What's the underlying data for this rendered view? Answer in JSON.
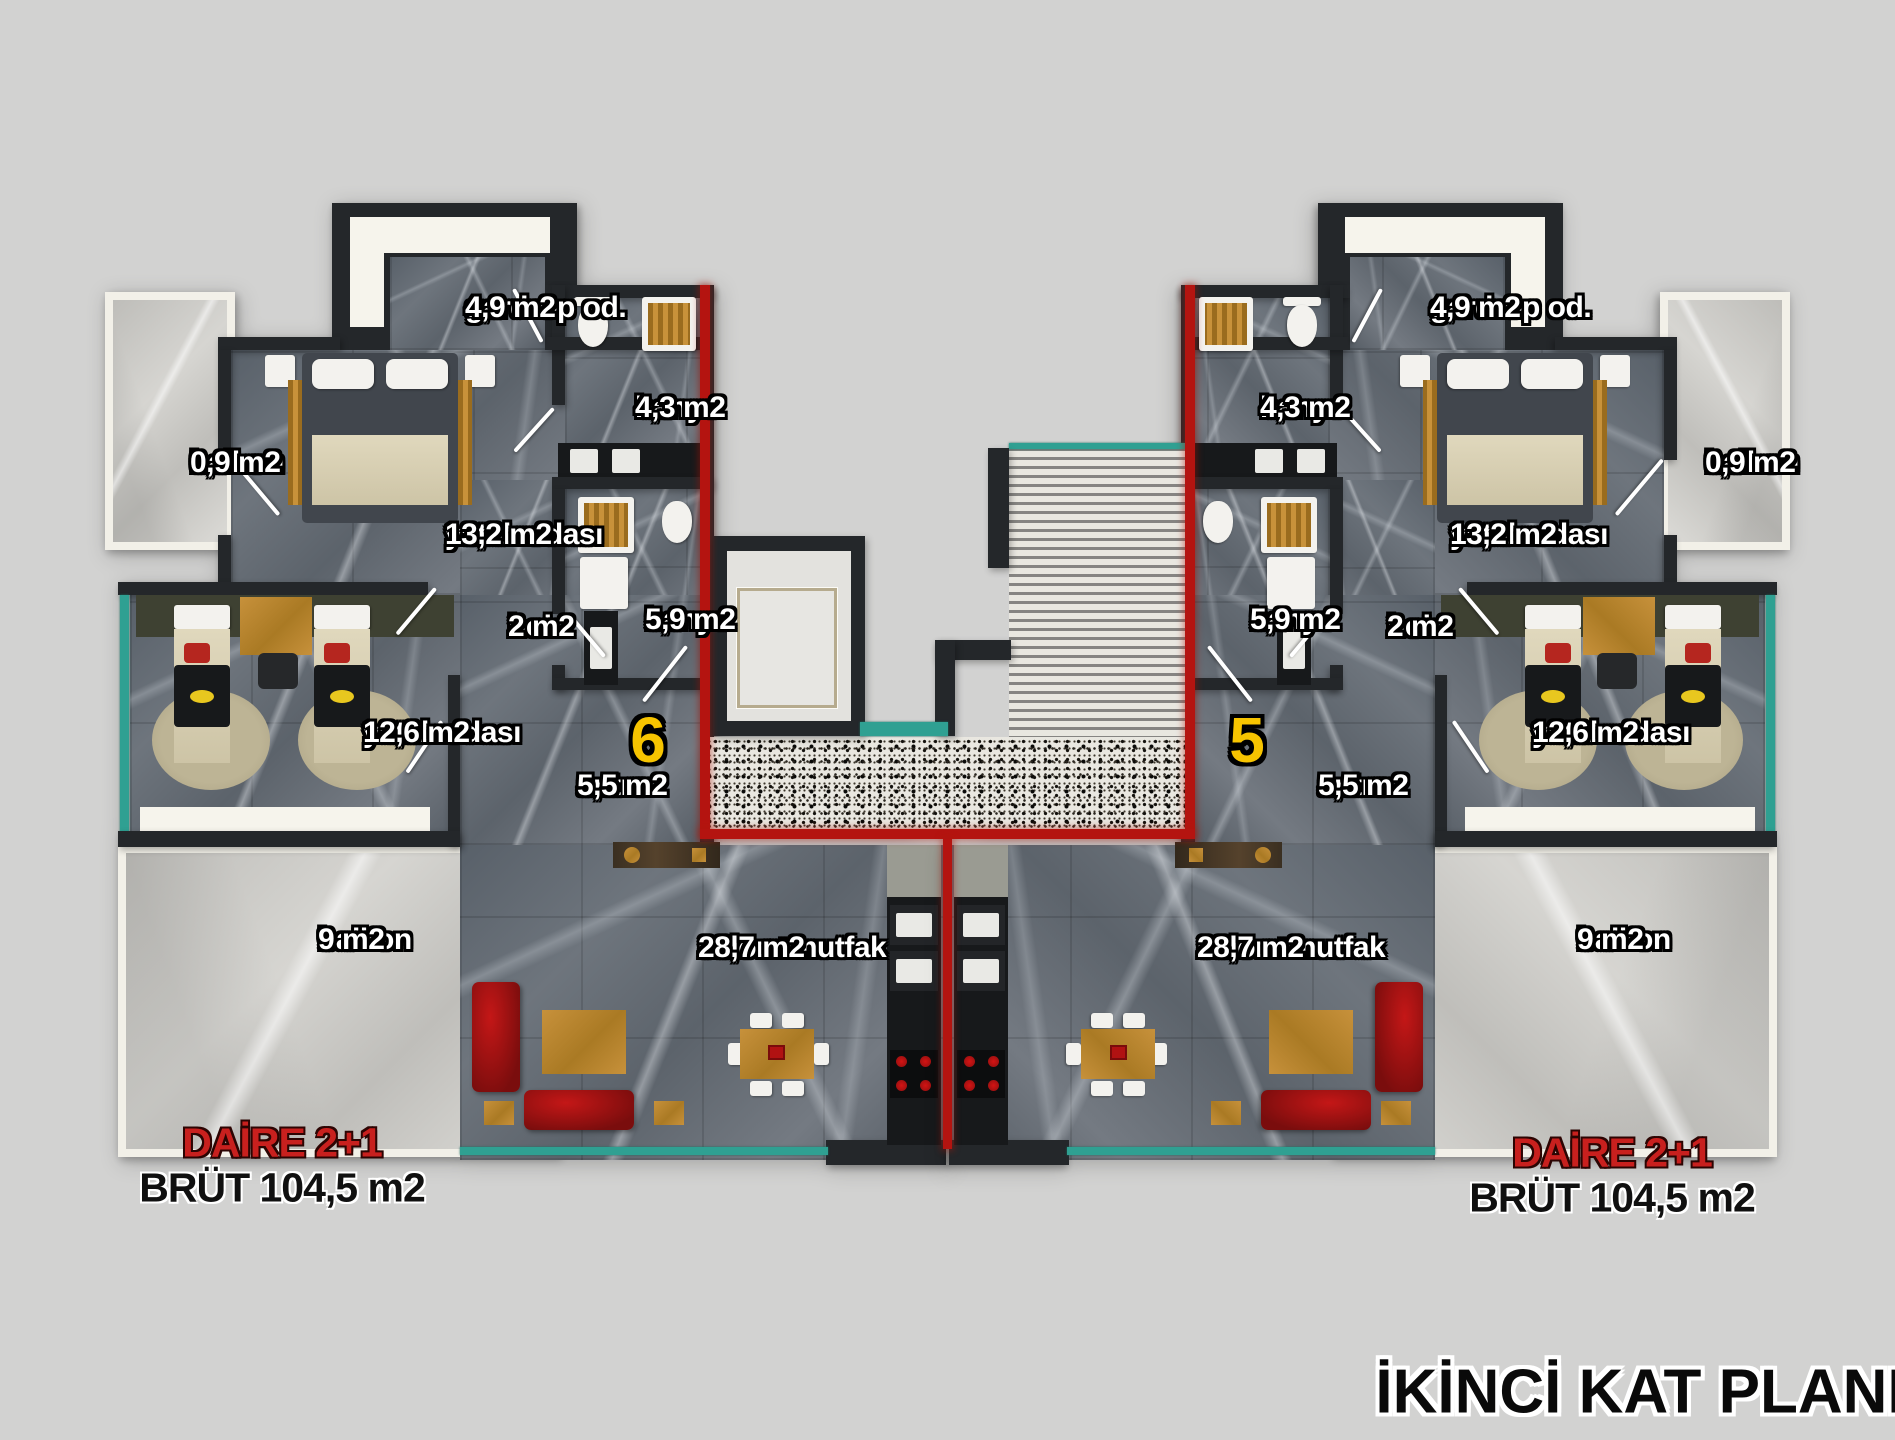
{
  "title": "İKİNCİ KAT PLANI",
  "units": [
    {
      "number": "6",
      "type_label": "DAİRE 2+1",
      "gross_area_label": "BRÜT 104,5 m2",
      "rooms": [
        {
          "name": "gardrop od.",
          "area": "4,9 m2"
        },
        {
          "name": "banyo",
          "area": "4,3 m2"
        },
        {
          "name": "balkon",
          "area": "0,9 m2"
        },
        {
          "name": "yatak odası",
          "area": "13,2 m2"
        },
        {
          "name": "hol",
          "area": "2 m2"
        },
        {
          "name": "banyo",
          "area": "5,9 m2"
        },
        {
          "name": "yatak odası",
          "area": "12,6 m2"
        },
        {
          "name": "antre",
          "area": "5,5 m2"
        },
        {
          "name": "balkon",
          "area": "9 m2"
        },
        {
          "name": "salon+mutfak",
          "area": "28,7 m2"
        }
      ]
    },
    {
      "number": "5",
      "type_label": "DAİRE 2+1",
      "gross_area_label": "BRÜT 104,5 m2",
      "rooms": [
        {
          "name": "gardrop od.",
          "area": "4,9 m2"
        },
        {
          "name": "banyo",
          "area": "4,3 m2"
        },
        {
          "name": "balkon",
          "area": "0,9 m2"
        },
        {
          "name": "yatak odası",
          "area": "13,2 m2"
        },
        {
          "name": "hol",
          "area": "2 m2"
        },
        {
          "name": "banyo",
          "area": "5,9 m2"
        },
        {
          "name": "yatak odası",
          "area": "12,6 m2"
        },
        {
          "name": "antre",
          "area": "5,5 m2"
        },
        {
          "name": "balkon",
          "area": "9 m2"
        },
        {
          "name": "salon+mutfak",
          "area": "28,7 m2"
        }
      ]
    }
  ],
  "colors": {
    "background": "#d2d2d1",
    "wall": "#24272a",
    "boundary_red": "#b41410",
    "unit_number_yellow": "#f7c400",
    "daire_red": "#c8201e",
    "glass_teal": "#2fa092"
  }
}
